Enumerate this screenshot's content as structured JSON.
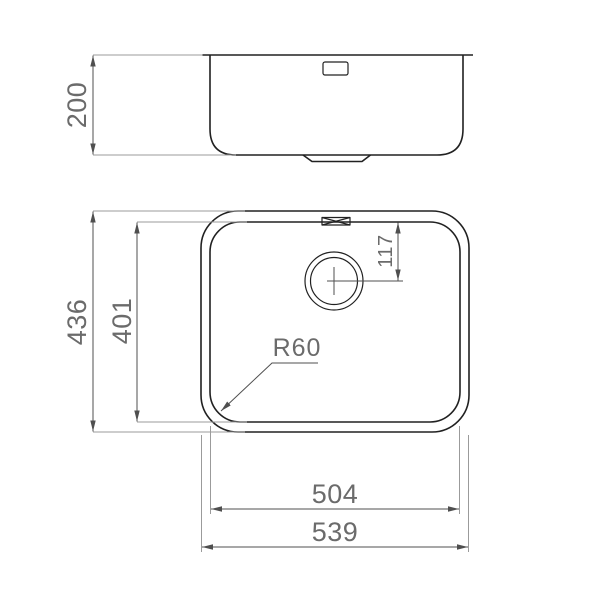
{
  "page": {
    "title": "undermount-sink-technical-drawing",
    "background": "#ffffff"
  },
  "colors": {
    "object_line": "#212121",
    "dimension_line": "#4f4f4f",
    "extension_line": "#9b9b9b",
    "dimension_text": "#6b6b6b"
  },
  "dimensions": {
    "side_height": "200",
    "overall_depth": "436",
    "bowl_depth": "401",
    "drain_offset": "117",
    "corner_radius": "R60",
    "bowl_width": "504",
    "overall_width": "539"
  }
}
